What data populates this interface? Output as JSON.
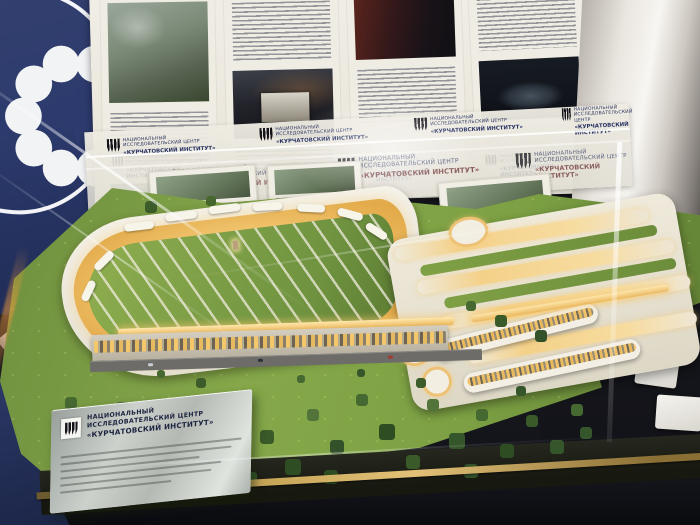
{
  "branding": {
    "line1": "НАЦИОНАЛЬНЫЙ",
    "line2": "ИССЛЕДОВАТЕЛЬСКИЙ ЦЕНТР",
    "line3": "«КУРЧАТОВСКИЙ ИНСТИТУТ»"
  },
  "plaque": {
    "line1": "НАЦИОНАЛЬНЫЙ",
    "line2": "ИССЛЕДОВАТЕЛЬСКИЙ ЦЕНТР",
    "line3": "«КУРЧАТОВСКИЙ ИНСТИТУТ»"
  },
  "icons": {
    "atom_ring": "atom-dots-ring-icon",
    "kurchatov_glyph": "kurchatov-tree-icon"
  },
  "colors": {
    "panel_navy": "#2c3a6d",
    "poster_cream": "#ece8dd",
    "model_white": "#f2eee3",
    "window_glow": "#f2c36b",
    "lawn_green": "#7d9f45",
    "tree_green": "#3f5f2c",
    "plaque_silver": "#c3c8c3",
    "brass_edge": "#caa85a"
  }
}
